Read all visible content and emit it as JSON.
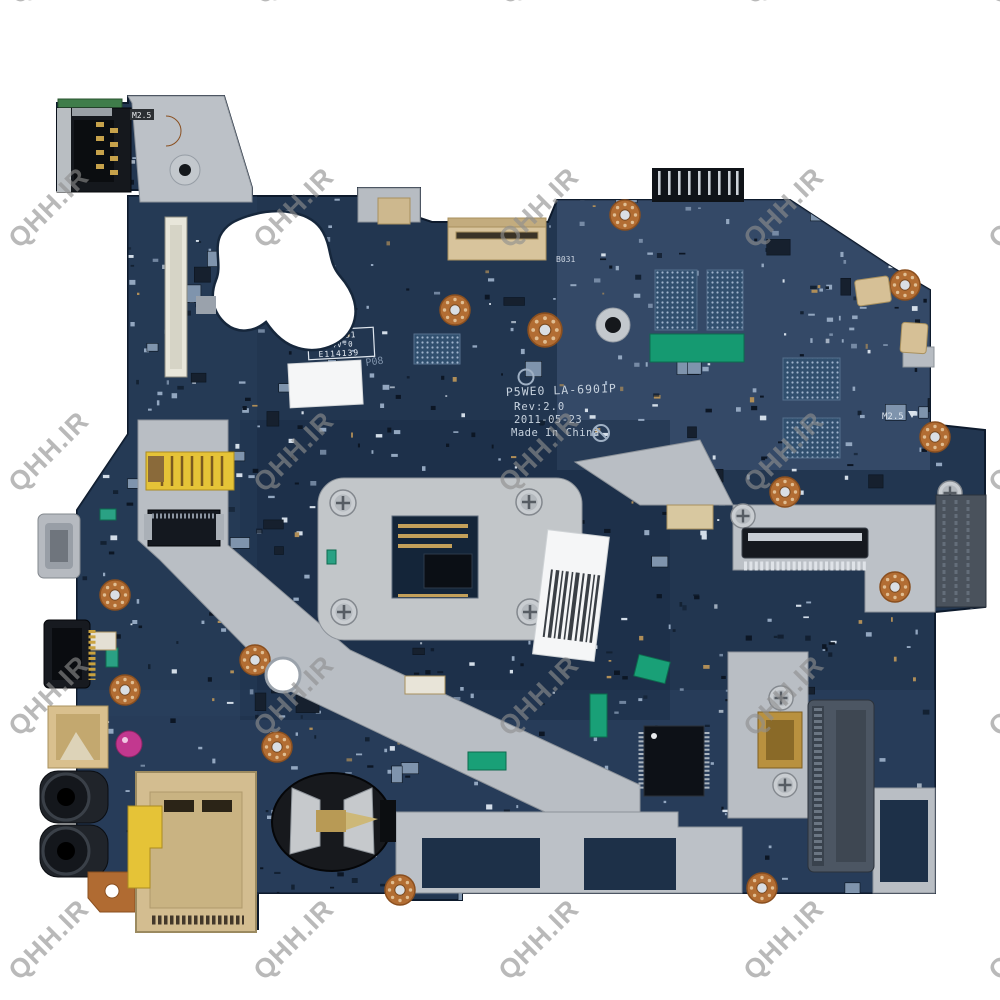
{
  "watermark": {
    "text": "QHH.IR",
    "color": "#8f8f8f"
  },
  "silkscreen": {
    "model": "P5WE0 LA-6901P",
    "revision": "Rev:2.0",
    "date": "2011-05-23",
    "origin": "Made In China",
    "p08": "P08",
    "m25": "M2.5",
    "b031": "B031"
  },
  "cert": {
    "ul": "UL",
    "line1": "YR-4B1",
    "line2": "94V-0",
    "line3": "E114139"
  },
  "colors": {
    "background": "#ffffff",
    "pcb_dark": "#223650",
    "pcb_light": "#44597a",
    "metal_gray": "#bcc1c7",
    "copper": "#b06b32",
    "connector_beige": "#d8c49c",
    "component_green": "#19a077",
    "kapton_yellow": "#e5c337",
    "sticker_white": "#f5f6f7",
    "black_component": "#12161c",
    "silkscreen_text": "#c7d2de"
  }
}
